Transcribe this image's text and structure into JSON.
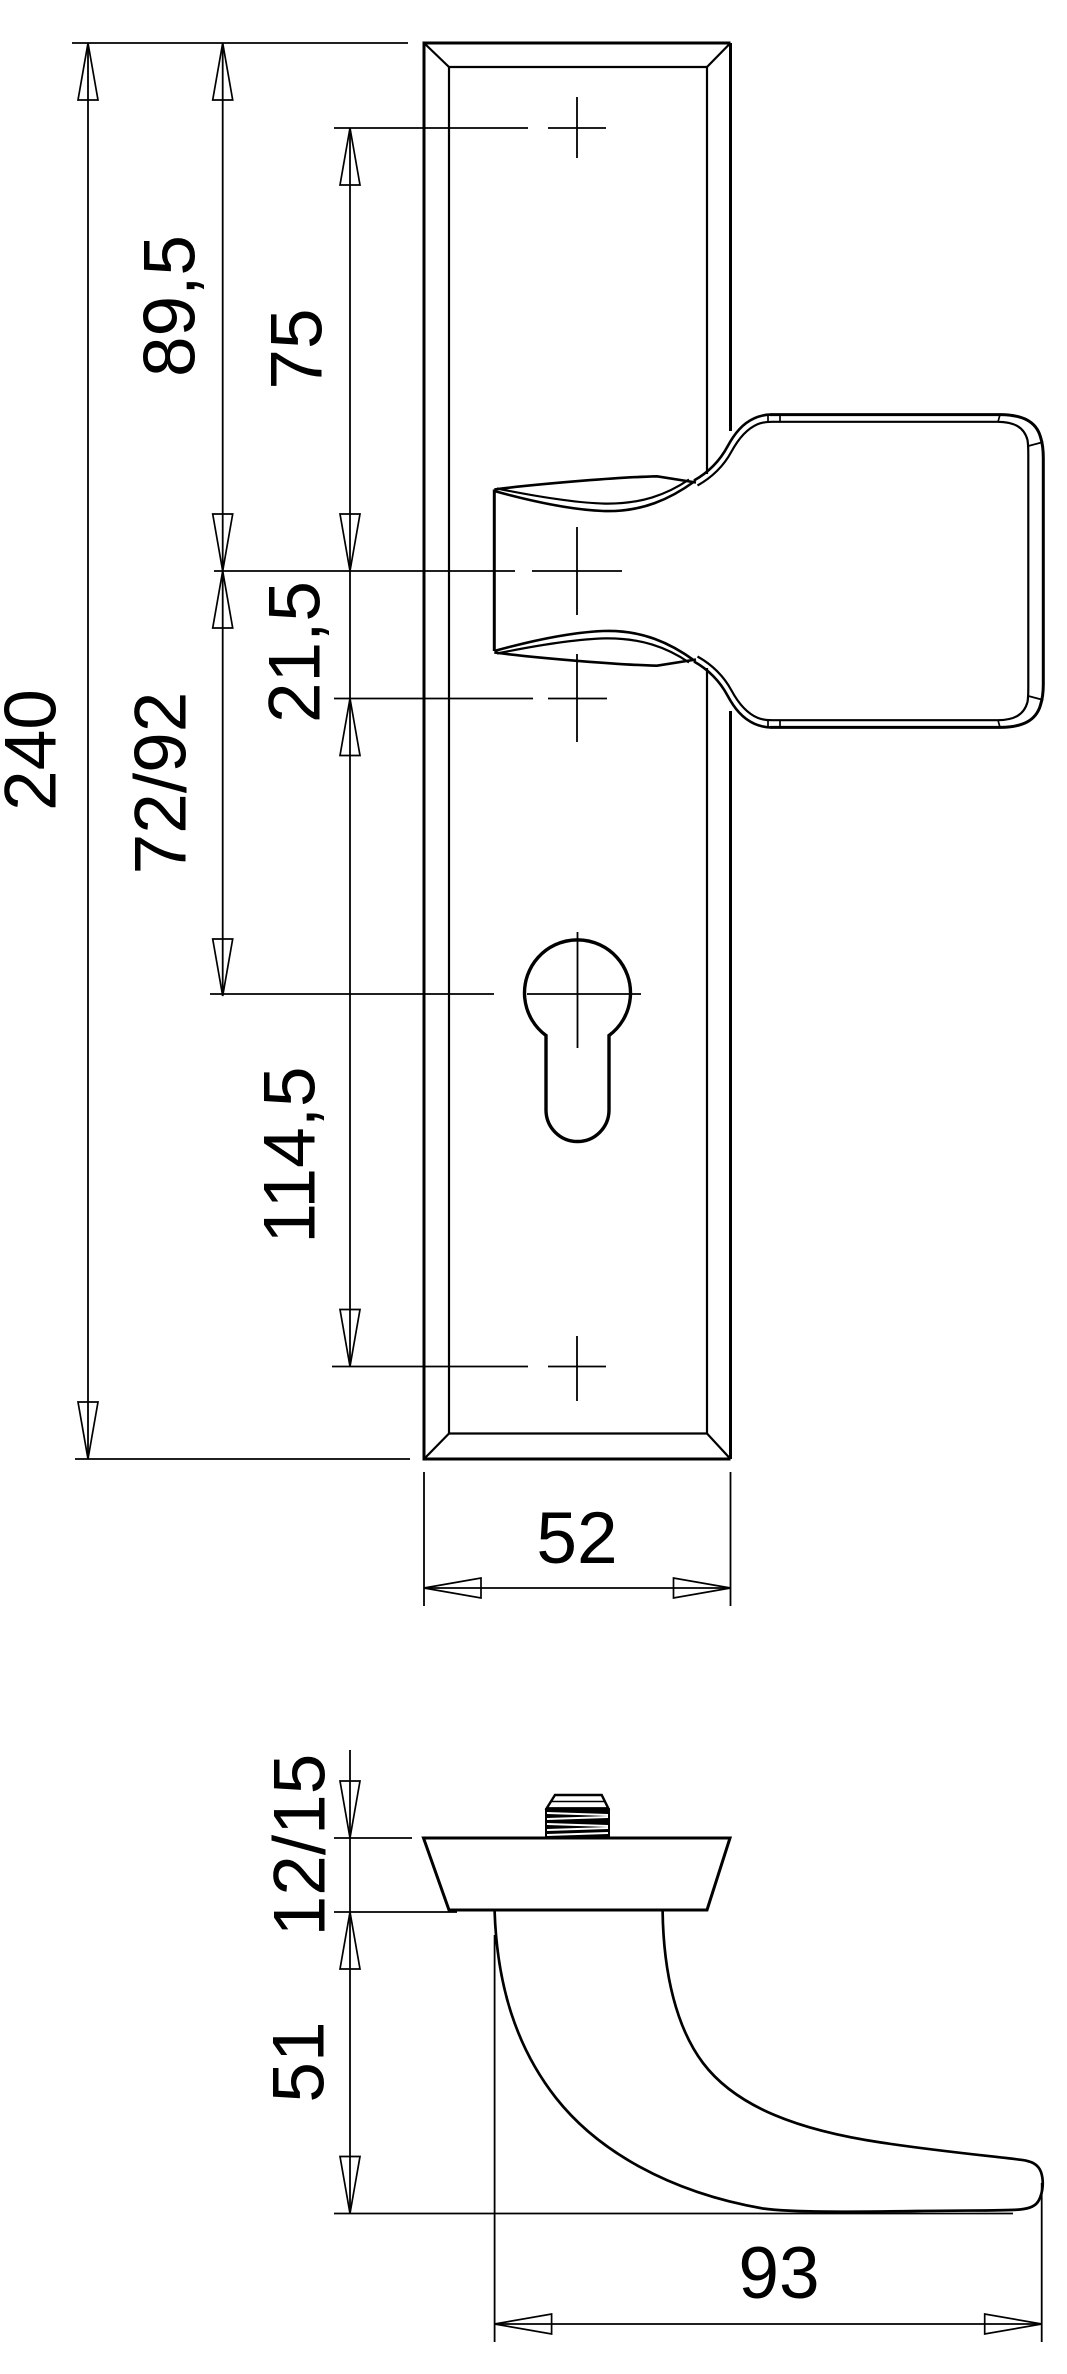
{
  "colors": {
    "line": "#000000",
    "background": "#ffffff"
  },
  "dimensions": {
    "overall_height": "240",
    "top_edge_to_handle_axis": "89,5",
    "top_hole_to_handle_axis": "75",
    "handle_axis_to_mid_hole": "21,5",
    "handle_axis_to_cylinder": "72/92",
    "mid_hole_to_bottom_hole": "114,5",
    "plate_width": "52",
    "plate_thickness": "12/15",
    "handle_drop_height": "51",
    "handle_length": "93"
  }
}
